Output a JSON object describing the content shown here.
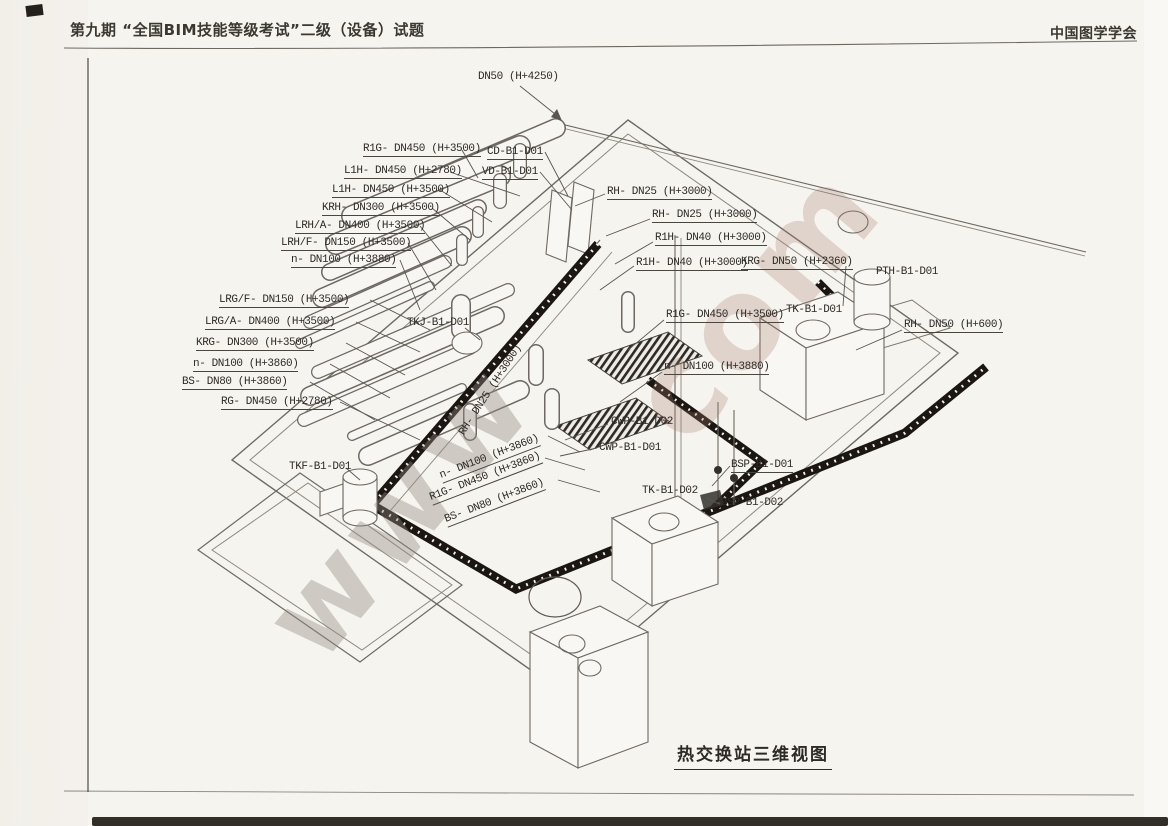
{
  "header": {
    "left_title": "第九期 “全国BIM技能等级考试”二级（设备）试题",
    "right_title": "中国图学学会"
  },
  "figure": {
    "caption": "热交换站三维视图"
  },
  "colors": {
    "paper": "#f6f4ef",
    "line_gray": "#6d6862",
    "insulated_pipe_black": "#1b1611",
    "label_ink": "#2e2a26",
    "scan_edge": "#332e28"
  },
  "watermark": {
    "fragments": [
      {
        "text": "www",
        "x": 290,
        "y": 575,
        "size": 115,
        "rot": -50,
        "color": "rgba(148,138,130,0.40)"
      },
      {
        "text": "com",
        "x": 655,
        "y": 350,
        "size": 125,
        "rot": -50,
        "color": "rgba(165,125,113,0.28)"
      }
    ]
  },
  "diagram": {
    "labels": [
      {
        "text": "DN50 (H+4250)",
        "x": 478,
        "y": 71,
        "u": false
      },
      {
        "text": "R1G- DN450 (H+3500)",
        "x": 363,
        "y": 143
      },
      {
        "text": "L1H- DN450 (H+2780)",
        "x": 344,
        "y": 165
      },
      {
        "text": "L1H- DN450 (H+3500)",
        "x": 332,
        "y": 184
      },
      {
        "text": "KRH- DN300 (H+3500)",
        "x": 322,
        "y": 202
      },
      {
        "text": "LRH/A- DN400 (H+3500)",
        "x": 295,
        "y": 220
      },
      {
        "text": "LRH/F- DN150 (H+3500)",
        "x": 281,
        "y": 237
      },
      {
        "text": "n- DN100 (H+3880)",
        "x": 291,
        "y": 254
      },
      {
        "text": "CD-B1-D01",
        "x": 487,
        "y": 146
      },
      {
        "text": "VD-B1-D01",
        "x": 482,
        "y": 166
      },
      {
        "text": "RH- DN25 (H+3000)",
        "x": 607,
        "y": 186
      },
      {
        "text": "RH- DN25 (H+3000)",
        "x": 652,
        "y": 209
      },
      {
        "text": "R1H- DN40 (H+3000)",
        "x": 655,
        "y": 232
      },
      {
        "text": "R1H- DN40 (H+3000)",
        "x": 636,
        "y": 257
      },
      {
        "text": "KRG- DN50 (H+2360)",
        "x": 741,
        "y": 256
      },
      {
        "text": "PTH-B1-D01",
        "x": 876,
        "y": 266,
        "u": false
      },
      {
        "text": "LRG/F- DN150 (H+3500)",
        "x": 219,
        "y": 294
      },
      {
        "text": "LRG/A- DN400 (H+3500)",
        "x": 205,
        "y": 316
      },
      {
        "text": "KRG- DN300 (H+3500)",
        "x": 196,
        "y": 337
      },
      {
        "text": "n- DN100 (H+3860)",
        "x": 193,
        "y": 358
      },
      {
        "text": "BS- DN80 (H+3860)",
        "x": 182,
        "y": 376
      },
      {
        "text": "RG- DN450 (H+2780)",
        "x": 221,
        "y": 396
      },
      {
        "text": "TKJ-B1-D01",
        "x": 407,
        "y": 317,
        "u": false
      },
      {
        "text": "R1G- DN450 (H+3500)",
        "x": 666,
        "y": 309
      },
      {
        "text": "TK-B1-D01",
        "x": 786,
        "y": 304,
        "u": false
      },
      {
        "text": "RH- DN50 (H+600)",
        "x": 904,
        "y": 319
      },
      {
        "text": "n- DN100 (H+3880)",
        "x": 664,
        "y": 361
      },
      {
        "text": "CWP-B1-D02",
        "x": 611,
        "y": 416,
        "u": false
      },
      {
        "text": "CWP-B1-D01",
        "x": 599,
        "y": 442,
        "u": false
      },
      {
        "text": "TKF-B1-D01",
        "x": 289,
        "y": 461,
        "u": false
      },
      {
        "text": "RH- DN25 (H+3000)",
        "x": 463,
        "y": 428,
        "rot": -57,
        "u": false
      },
      {
        "text": "n- DN100 (H+3860)",
        "x": 441,
        "y": 470,
        "rot": -21
      },
      {
        "text": "R1G- DN450 (H+3860)",
        "x": 431,
        "y": 492,
        "rot": -21
      },
      {
        "text": "BS- DN80 (H+3860)",
        "x": 446,
        "y": 514,
        "rot": -21
      },
      {
        "text": "TK-B1-D02",
        "x": 642,
        "y": 485,
        "u": false
      },
      {
        "text": "BSP-B1-D01",
        "x": 731,
        "y": 459
      },
      {
        "text": "BSP-B1-D02",
        "x": 721,
        "y": 497,
        "u": false
      }
    ]
  }
}
